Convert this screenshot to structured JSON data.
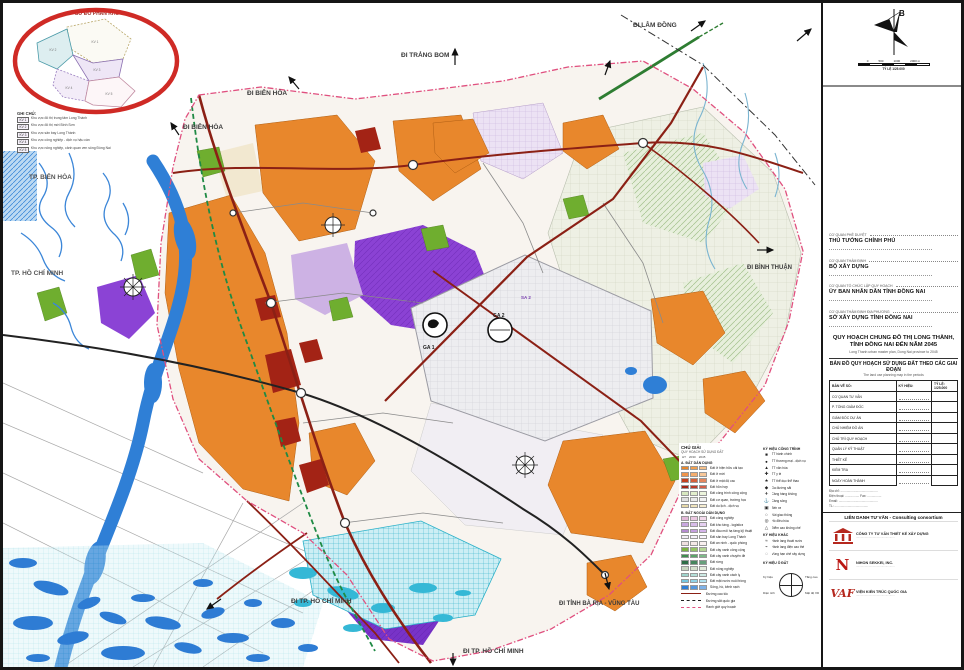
{
  "inset": {
    "title": "SƠ ĐỒ PHÂN KHU",
    "legend_title": "GHI CHÚ:",
    "rows": [
      {
        "code": "KV 1",
        "text": "Khu vực đô thị trung tâm Long Thành"
      },
      {
        "code": "KV 2",
        "text": "Khu vực đô thị mới Bình Sơn"
      },
      {
        "code": "KV 3",
        "text": "Khu vực sân bay Long Thành"
      },
      {
        "code": "KV 4",
        "text": "Khu vực công nghiệp - dịch vụ hậu cần"
      },
      {
        "code": "KV 5",
        "text": "Khu vực nông nghiệp, cảnh quan ven sông Đồng Nai"
      }
    ]
  },
  "map": {
    "labels": {
      "trang_bom": "ĐI TRẢNG BOM",
      "lam_dong": "ĐI LÂM ĐỒNG",
      "bien_hoa_1": "ĐI BIÊN HÒA",
      "bien_hoa_2": "ĐI BIÊN HÒA",
      "binh_thuan": "ĐI BÌNH THUẬN",
      "tp_bien_hoa": "TP. BIÊN HÒA",
      "tp_hcm": "TP. HỒ CHÍ MINH",
      "di_tp_hcm_1": "ĐI TP. HỒ CHÍ MINH",
      "di_tp_hcm_2": "ĐI TP. HỒ CHÍ MINH",
      "ba_ria": "ĐI TỈNH BÀ RỊA - VŨNG TÀU",
      "ga1": "GA 1",
      "ga2": "GA 2",
      "sa1": "SA 1",
      "sa2": "SA 2"
    }
  },
  "legend": {
    "title": "CHÚ GIẢI",
    "subtitle": "QUY HOẠCH SỬ DỤNG ĐẤT",
    "phases": [
      "HT",
      "2030",
      "2045"
    ],
    "group_a_title": "A. ĐẤT DÂN DỤNG",
    "rows_a": [
      {
        "colors": [
          "#e8872c",
          "#f0a050",
          "#f5c08a"
        ],
        "label": "Đất ở hiện hữu cải tạo"
      },
      {
        "colors": [
          "#f0944a",
          "#f4ad6e",
          "#f8c89a"
        ],
        "label": "Đất ở mới"
      },
      {
        "colors": [
          "#c4401e",
          "#d4603a",
          "#e4875e"
        ],
        "label": "Đất ở mật độ cao"
      },
      {
        "colors": [
          "#a32315",
          "#bb3a28",
          "#d4604a"
        ],
        "label": "Đất hỗn hợp"
      },
      {
        "colors": [
          "#d8e8c0",
          "#e2eecc",
          "#ecf4dc"
        ],
        "label": "Đất công trình công cộng"
      },
      {
        "colors": [
          "#e0e0e0",
          "#eaeaea",
          "#f2f2f2"
        ],
        "label": "Đất cơ quan, trường học"
      },
      {
        "colors": [
          "#e7d9a8",
          "#efe3bc",
          "#f5ecd0"
        ],
        "label": "Đất du lịch - dịch vụ"
      }
    ],
    "group_b_title": "B. ĐẤT NGOÀI DÂN DỤNG",
    "rows_b": [
      {
        "colors": [
          "#e3b8d8",
          "#ecc9e2",
          "#f3daec"
        ],
        "label": "Đất công nghiệp"
      },
      {
        "colors": [
          "#c9a8e0",
          "#d7bce8",
          "#e5d0f0"
        ],
        "label": "Đất kho tàng - logistics"
      },
      {
        "colors": [
          "#b48ad0",
          "#c49ede",
          "#d4b4ea"
        ],
        "label": "Đất đầu mối hạ tầng kỹ thuật"
      },
      {
        "colors": [
          "#f2eef6",
          "#f6f2fa",
          "#faf6fd"
        ],
        "label": "Đất sân bay Long Thành"
      },
      {
        "colors": [
          "#efe0e0",
          "#f4e8e8",
          "#f9f0f0"
        ],
        "label": "Đất an ninh - quốc phòng"
      }
    ],
    "rows_c": [
      {
        "colors": [
          "#7cb342",
          "#94c465",
          "#b4d694"
        ],
        "label": "Đất cây xanh công cộng"
      },
      {
        "colors": [
          "#3e8e4e",
          "#5aa468",
          "#7cba88"
        ],
        "label": "Đất cây xanh chuyên đề"
      },
      {
        "colors": [
          "#2e6e46",
          "#47855e",
          "#68a07c"
        ],
        "label": "Đất rừng"
      },
      {
        "colors": [
          "#c9d6c0",
          "#d6e0ce",
          "#e4ecdc"
        ],
        "label": "Đất nông nghiệp"
      },
      {
        "colors": [
          "#9fd4cc",
          "#b4dfd8",
          "#cdeae4"
        ],
        "label": "Đất cây xanh cách ly"
      },
      {
        "colors": [
          "#74c7e0",
          "#90d4e8",
          "#b0e2f0"
        ],
        "label": "Đất mặt nước nuôi trồng"
      },
      {
        "colors": [
          "#2f7fd6",
          "#5598de",
          "#7fb2e8"
        ],
        "label": "Sông, hồ, kênh rạch"
      }
    ],
    "line_rows": {
      "hwy": "Đường cao tốc",
      "rail": "Đường sắt quốc gia",
      "bnd": "Ranh giới quy hoạch"
    },
    "symbols_title": "KÝ HIỆU CÔNG TRÌNH",
    "symbols": [
      {
        "glyph": "■",
        "label": "TT hành chính"
      },
      {
        "glyph": "●",
        "label": "TT thương mại - dịch vụ"
      },
      {
        "glyph": "▲",
        "label": "TT văn hóa"
      },
      {
        "glyph": "✚",
        "label": "TT y tế"
      },
      {
        "glyph": "★",
        "label": "TT thể dục thể thao"
      },
      {
        "glyph": "◆",
        "label": "Ga đường sắt"
      },
      {
        "glyph": "✈",
        "label": "Cảng hàng không"
      },
      {
        "glyph": "⚓",
        "label": "Cảng sông"
      },
      {
        "glyph": "▣",
        "label": "Bến xe"
      },
      {
        "glyph": "○",
        "label": "Nút giao thông"
      },
      {
        "glyph": "◎",
        "label": "Hồ điều hòa"
      },
      {
        "glyph": "△",
        "label": "Điểm cao khống chế"
      }
    ],
    "others_title": "KÝ HIỆU KHÁC",
    "others": [
      {
        "glyph": "≈",
        "label": "Hành lang thoát nước"
      },
      {
        "glyph": "⌁",
        "label": "Hành lang điện cao thế"
      },
      {
        "glyph": "◌",
        "label": "Vùng hạn chế xây dựng"
      }
    ],
    "block_note": {
      "title": "KÝ HIỆU Ô ĐẤT",
      "tl": "Ký hiệu",
      "tr": "Tầng cao",
      "bl": "Diện tích",
      "br": "Mật độ XD"
    }
  },
  "titleblock": {
    "compass": {
      "north": "B",
      "ticks": [
        "0",
        "500",
        "1000",
        "2000 m"
      ],
      "caption": "TỶ LỆ 1/25.000"
    },
    "agencies": [
      {
        "label": "CƠ QUAN PHÊ DUYỆT",
        "name": "THỦ TƯỚNG CHÍNH PHỦ"
      },
      {
        "label": "CƠ QUAN THẨM ĐỊNH",
        "name": "BỘ XÂY DỰNG"
      },
      {
        "label": "CƠ QUAN TỔ CHỨC LẬP QUY HOẠCH",
        "name": "ỦY BAN NHÂN DÂN TỈNH ĐỒNG NAI"
      },
      {
        "label": "CƠ QUAN THẨM ĐỊNH ĐỊA PHƯƠNG",
        "name": "SỞ XÂY DỰNG TỈNH ĐỒNG NAI"
      }
    ],
    "project_title": "QUY HOẠCH CHUNG ĐÔ THỊ LONG THÀNH, TỈNH ĐỒNG NAI ĐẾN NĂM 2045",
    "project_subtitle": "Long Thanh urban master plan, Dong Nai province to 2045",
    "drawing_title": "BẢN ĐỒ QUY HOẠCH SỬ DỤNG ĐẤT THEO CÁC GIAI ĐOẠN",
    "drawing_subtitle": "The land use planning map in the periods",
    "table": {
      "header": [
        "BẢN VẼ SỐ:",
        "KÝ HIỆU:",
        "TỶ LỆ: 1/25.000"
      ],
      "rows": [
        {
          "label": "CƠ QUAN TƯ VẤN"
        },
        {
          "label": "P. TỔNG GIÁM ĐỐC"
        },
        {
          "label": "GIÁM ĐỐC DỰ ÁN"
        },
        {
          "label": "CHỦ NHIỆM ĐỒ ÁN"
        },
        {
          "label": "CHỦ TRÌ QUY HOẠCH"
        },
        {
          "label": "QUẢN LÝ KỸ THUẬT"
        },
        {
          "label": "THIẾT KẾ"
        },
        {
          "label": "KIỂM TRA"
        },
        {
          "label": "NGÀY HOÀN THÀNH"
        }
      ]
    },
    "address_lines": [
      "Địa chỉ: ..........................................",
      "Điện thoại: ................  Fax: ................",
      "Email: ............................................",
      "TL: ......................................"
    ],
    "consortium": "LIÊN DANH TƯ VẤN - Consulting consortium",
    "logos": [
      {
        "glyph": "",
        "name": "CÔNG TY TƯ VẤN THIẾT KẾ XÂY DỰNG",
        "line": "................................................"
      },
      {
        "glyph": "N",
        "name": "NIHON SEKKEI, INC.",
        "line": "................................................"
      },
      {
        "glyph": "VAF",
        "name": "VIỆN KIẾN TRÚC QUỐC GIA",
        "line": "................................................"
      }
    ]
  }
}
